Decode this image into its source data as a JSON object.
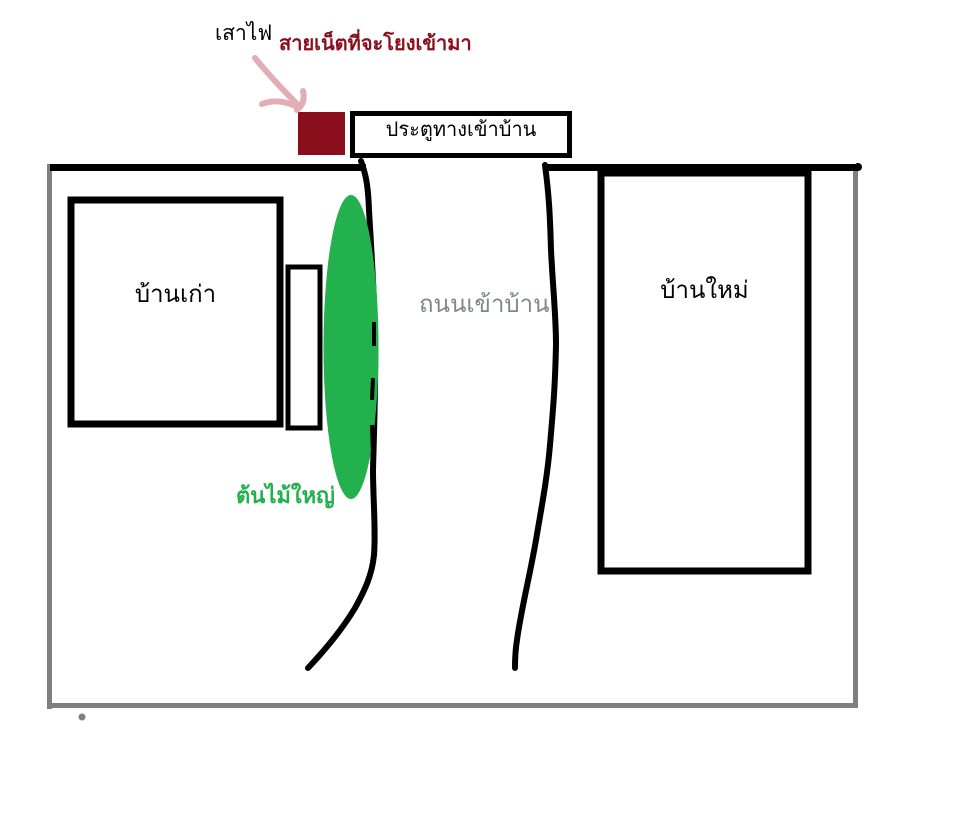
{
  "diagram": {
    "title_hint": "hand-drawn property map",
    "labels": {
      "pole": "เสาไฟ",
      "cable": "สายเน็ตที่จะโยงเข้ามา",
      "entrance": "ประตูทางเข้าบ้าน",
      "old_house": "บ้านเก่า",
      "road": "ถนนเข้าบ้าน",
      "new_house": "บ้านใหม่",
      "tree": "ต้นไม้ใหญ่"
    },
    "colors": {
      "dark_red": "#8B0E1C",
      "pink": "#E2ADB5",
      "green": "#22B14C",
      "boundary_gray": "#808080",
      "road_text_gray": "#818689",
      "black": "#000000",
      "white": "#ffffff"
    }
  }
}
